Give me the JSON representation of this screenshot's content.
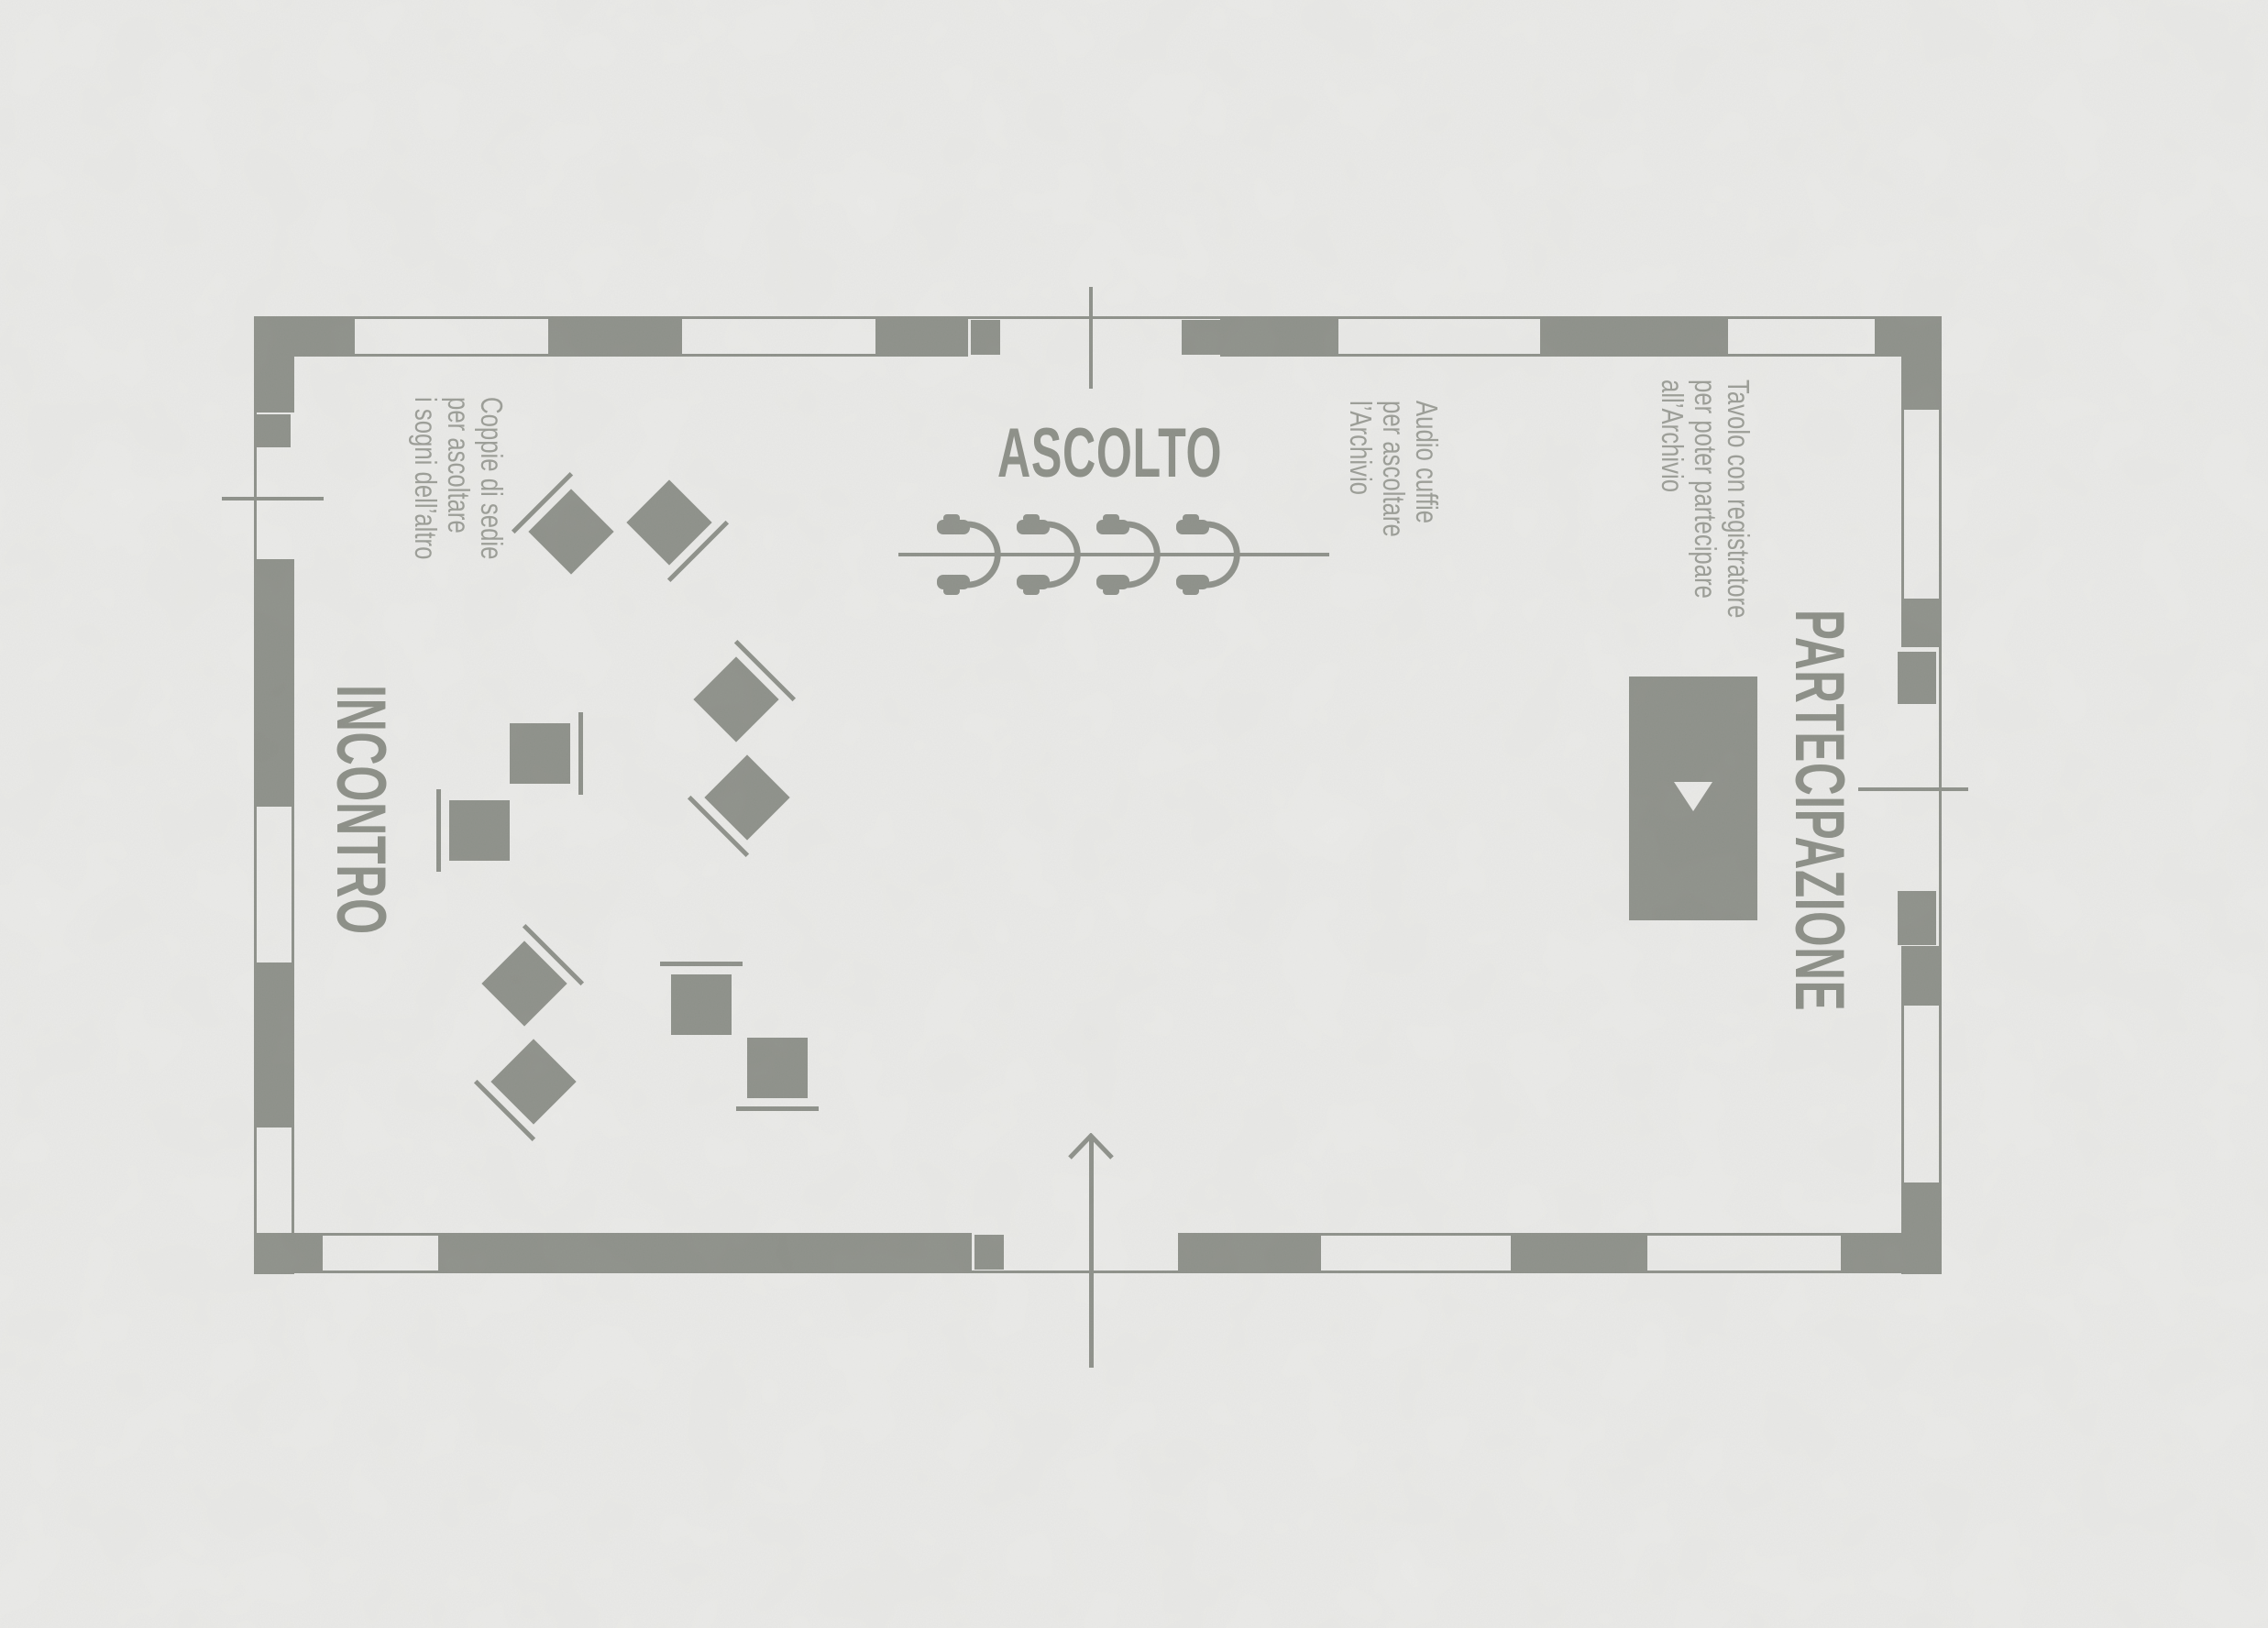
{
  "colors": {
    "ink": "#8c8f88",
    "paper": "#ebebe9",
    "heading_text": "#8a8d85",
    "note_text": "#9a9c95"
  },
  "zones": {
    "ascolto": {
      "label": "ASCOLTO"
    },
    "incontro": {
      "label": "INCONTRO"
    },
    "partecipazione": {
      "label": "PARTECIPAZIONE"
    }
  },
  "annotations": {
    "coppie": {
      "lines": [
        "Coppie di sedie",
        "per ascoltare",
        "i sogni dell’altro"
      ]
    },
    "audio": {
      "lines": [
        "Audio cuffie",
        "per ascoltare",
        "l’Archivio"
      ]
    },
    "tavolo": {
      "lines": [
        "Tavolo con registratore",
        "per poter partecipare",
        "all’Archivio"
      ]
    }
  },
  "furniture": {
    "chair_pair_count": 5,
    "chair_count": 10,
    "headphone_count": 4,
    "recorder_table_count": 1
  },
  "plan": {
    "wall_style": "alternating filled segments",
    "openings": {
      "top": 1,
      "bottom": 1,
      "left": 1,
      "right": 1
    },
    "entrance_arrow_direction": "up"
  }
}
